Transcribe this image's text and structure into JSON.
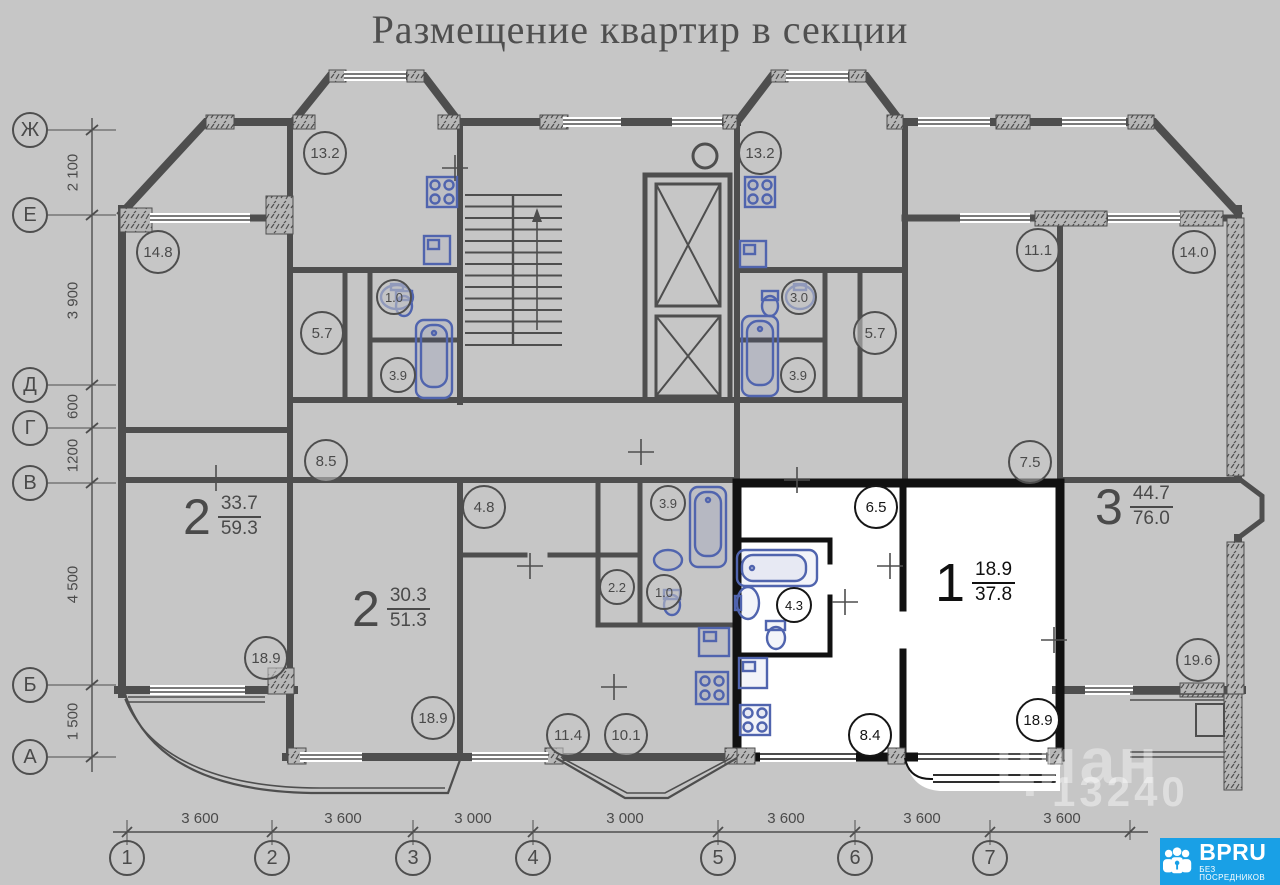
{
  "title": "Размещение квартир в секции",
  "apartments": [
    {
      "type": "2",
      "upper": "33.7",
      "lower": "59.3"
    },
    {
      "type": "2",
      "upper": "30.3",
      "lower": "51.3"
    },
    {
      "type": "1",
      "upper": "18.9",
      "lower": "37.8"
    },
    {
      "type": "3",
      "upper": "44.7",
      "lower": "76.0"
    }
  ],
  "rooms": [
    "13.2",
    "13.2",
    "14.8",
    "11.1",
    "14.0",
    "1.0",
    "3.0",
    "5.7",
    "5.7",
    "3.9",
    "3.9",
    "8.5",
    "7.5",
    "4.8",
    "3.9",
    "6.5",
    "2.2",
    "1.0",
    "4.3",
    "18.9",
    "19.6",
    "18.9",
    "11.4",
    "10.1",
    "8.4",
    "18.9"
  ],
  "axes": {
    "rows": [
      "Ж",
      "Е",
      "Д",
      "Г",
      "В",
      "Б",
      "А"
    ],
    "row_dims": [
      "2 100",
      "3 900",
      "600",
      "1200",
      "4 500",
      "1 500"
    ],
    "cols": [
      "1",
      "2",
      "3",
      "4",
      "5",
      "6",
      "7"
    ],
    "col_dims": [
      "3 600",
      "3 600",
      "3 000",
      "3 000",
      "3 600",
      "3 600",
      "3 600"
    ]
  },
  "watermark": {
    "brand": "циан",
    "code": "13240"
  },
  "badge": {
    "brand": "BPRU",
    "tagline": "БЕЗ ПОСРЕДНИКОВ"
  },
  "colors": {
    "wall_gray": "#4e4e4e",
    "highlight_walls": "#111111",
    "fixture_blue": "#5064ae",
    "badge_blue": "#19a0e6",
    "background": "#c6c6c6"
  }
}
